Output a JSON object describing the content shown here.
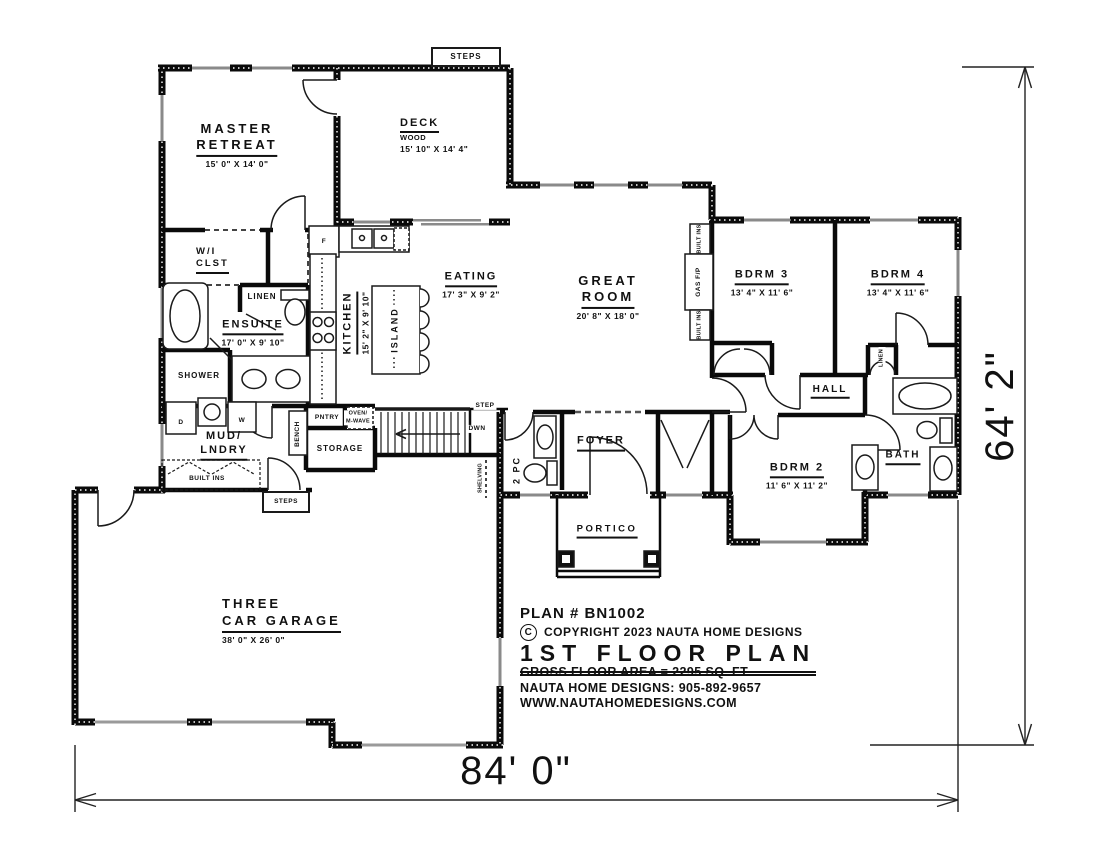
{
  "sheet": {
    "plan_number": "PLAN # BN1002",
    "copyright_symbol": "C",
    "copyright": "COPYRIGHT 2023 NAUTA HOME DESIGNS",
    "title": "1ST FLOOR PLAN",
    "gross_area": "GROSS FLOOR AREA  =  2295  SQ. FT.",
    "phone": "NAUTA HOME DESIGNS:  905-892-9657",
    "website": "WWW.NAUTAHOMEDESIGNS.COM"
  },
  "dimensions": {
    "overall_width": "84' 0\"",
    "overall_height": "64' 2\""
  },
  "rooms": {
    "master": {
      "line1": "MASTER",
      "line2": "RETREAT",
      "dims": "15' 0\" X 14' 0\""
    },
    "deck": {
      "name": "DECK",
      "material": "WOOD",
      "dims": "15' 10\" X 14' 4\""
    },
    "wic": {
      "line1": "W/I",
      "line2": "CLST"
    },
    "ensuite": {
      "name": "ENSUITE",
      "dims": "17' 0\" X 9' 10\""
    },
    "shower": {
      "name": "SHOWER"
    },
    "kitchen": {
      "name": "KITCHEN",
      "dims": "15' 2\" X 9' 10\""
    },
    "island": {
      "name": "ISLAND"
    },
    "eating": {
      "name": "EATING",
      "dims": "17' 3\" X 9' 2\""
    },
    "great_room": {
      "line1": "GREAT",
      "line2": "ROOM",
      "dims": "20' 8\" X 18' 0\""
    },
    "bdrm3": {
      "name": "BDRM 3",
      "dims": "13' 4\" X 11' 6\""
    },
    "bdrm4": {
      "name": "BDRM 4",
      "dims": "13' 4\" X 11' 6\""
    },
    "bdrm2": {
      "name": "BDRM 2",
      "dims": "11' 6\" X 11' 2\""
    },
    "hall": {
      "name": "HALL"
    },
    "bath": {
      "name": "BATH"
    },
    "foyer": {
      "name": "FOYER"
    },
    "two_pc": {
      "name": "2 PC"
    },
    "portico": {
      "name": "PORTICO"
    },
    "mud_lndry": {
      "line1": "MUD/",
      "line2": "LNDRY"
    },
    "storage": {
      "name": "STORAGE"
    },
    "garage": {
      "line1": "THREE",
      "line2": "CAR GARAGE",
      "dims": "38' 0\" X 26' 0\""
    }
  },
  "features": {
    "steps_deck": "STEPS",
    "steps_garage": "STEPS",
    "step": "STEP",
    "dwn": "DWN",
    "linen_ensuite": "LINEN",
    "linen_hall": "LINEN",
    "gas_fp": "GAS F/P",
    "built_ins_upper": "BUILT INS",
    "built_ins_lower": "BUILT INS",
    "built_ins_mud": "BUILT INS",
    "bench": "BENCH",
    "pntry": "PNTRY",
    "oven_line1": "OVEN/",
    "oven_line2": "M-WAVE",
    "shelving": "SHELVING",
    "fridge": "F",
    "dryer": "D",
    "washer": "W"
  }
}
